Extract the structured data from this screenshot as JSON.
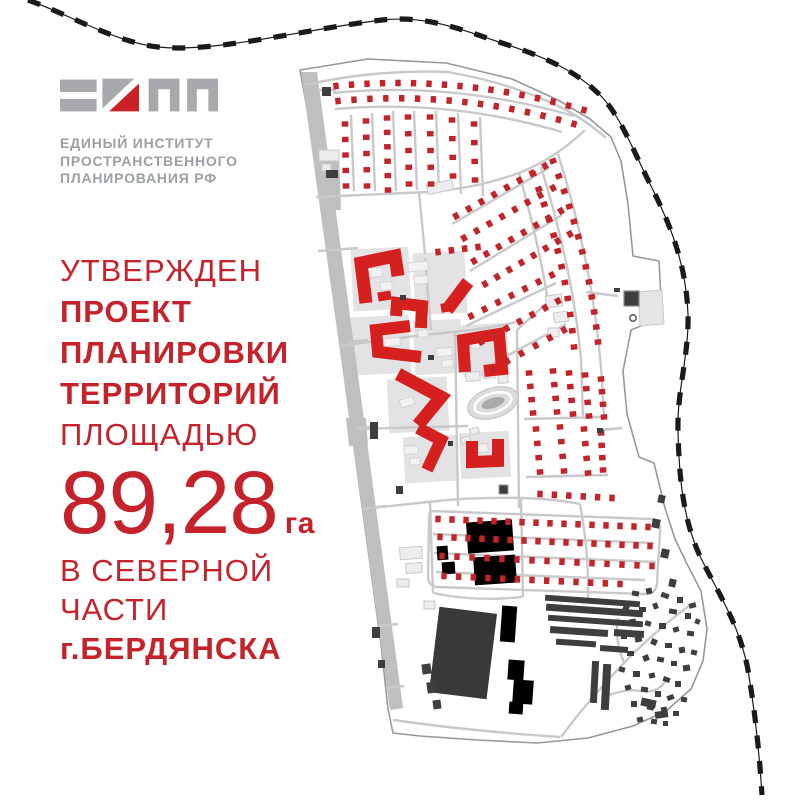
{
  "brand": {
    "org_lines": [
      "ЕДИНЫЙ ИНСТИТУТ",
      "ПРОСТРАНСТВЕННОГО",
      "ПЛАНИРОВАНИЯ РФ"
    ]
  },
  "headline": {
    "top_lines": [
      {
        "text": "УТВЕРЖДЕН",
        "bold": false
      },
      {
        "text": "ПРОЕКТ",
        "bold": true
      },
      {
        "text": "ПЛАНИРОВКИ",
        "bold": true
      },
      {
        "text": "ТЕРРИТОРИЙ",
        "bold": true
      },
      {
        "text": "ПЛОЩАДЬЮ",
        "bold": false
      }
    ],
    "area_value": "89,28",
    "area_unit": "га",
    "bottom_lines": [
      {
        "text": "В СЕВЕРНОЙ",
        "bold": false
      },
      {
        "text": "ЧАСТИ",
        "bold": false
      },
      {
        "text": "г.БЕРДЯНСКА",
        "bold": true
      }
    ]
  },
  "colors": {
    "accent_red": "#c5222b",
    "org_text_gray": "#9aa0a6",
    "logo_gray": "#a7a9ac",
    "logo_red": "#cb2026",
    "map": {
      "building_red": "#d6201f",
      "house_red": "#c2242c",
      "dark_building": "#3e3e41",
      "industrial_dark": "#39393c",
      "road_gray": "#c9c9cb",
      "road_strip": "#bfbfc1",
      "boundary_gray": "#98989a",
      "block_gray": "#e3e3e5",
      "light_building": "#ededef",
      "light_building_stroke": "#c8c8ca",
      "inner_building": "#f2f2f3",
      "inner_building_stroke": "#d0d0d2",
      "railway_black": "#1a1a1a",
      "stadium_fill": "#dcdcde",
      "stadium_center": "#a9a9ab"
    }
  }
}
